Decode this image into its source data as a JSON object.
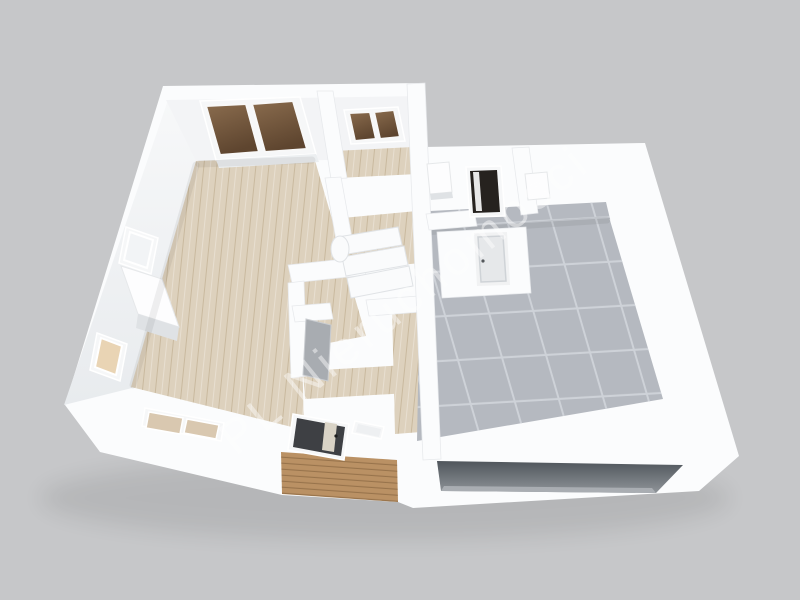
{
  "scene": {
    "kind": "3d-floorplan-render",
    "width": 800,
    "height": 600
  },
  "watermark": {
    "text": "PL Nieruchomosci"
  },
  "colors": {
    "background": "#c6c7c9",
    "wall": "#fbfcfd",
    "wall_inner": "#f3f4f6",
    "wood": "#ddd1bd",
    "wood_grain": "#b29a77",
    "tile": "#b5b9c0",
    "tile_line": "#ced2d8",
    "porch": "#ba9164",
    "porch_line": "#6e4e2d",
    "glass_brown": "#7a5e41",
    "front_door": "#3e4044",
    "entry_door": "#26221f",
    "interior_door": "#e6e8ea",
    "garage_dark": "#50565c",
    "watermark": "#ffffff"
  },
  "features": [
    "living-room-wood-floor",
    "sliding-glass-door",
    "top-room-window",
    "left-wall-windows",
    "partition-wall",
    "staircase",
    "hallway",
    "front-door-with-glass-stripe",
    "front-double-window",
    "wood-porch-deck",
    "entry-door-dark",
    "interior-white-door",
    "tiled-hall",
    "garage-opening"
  ]
}
